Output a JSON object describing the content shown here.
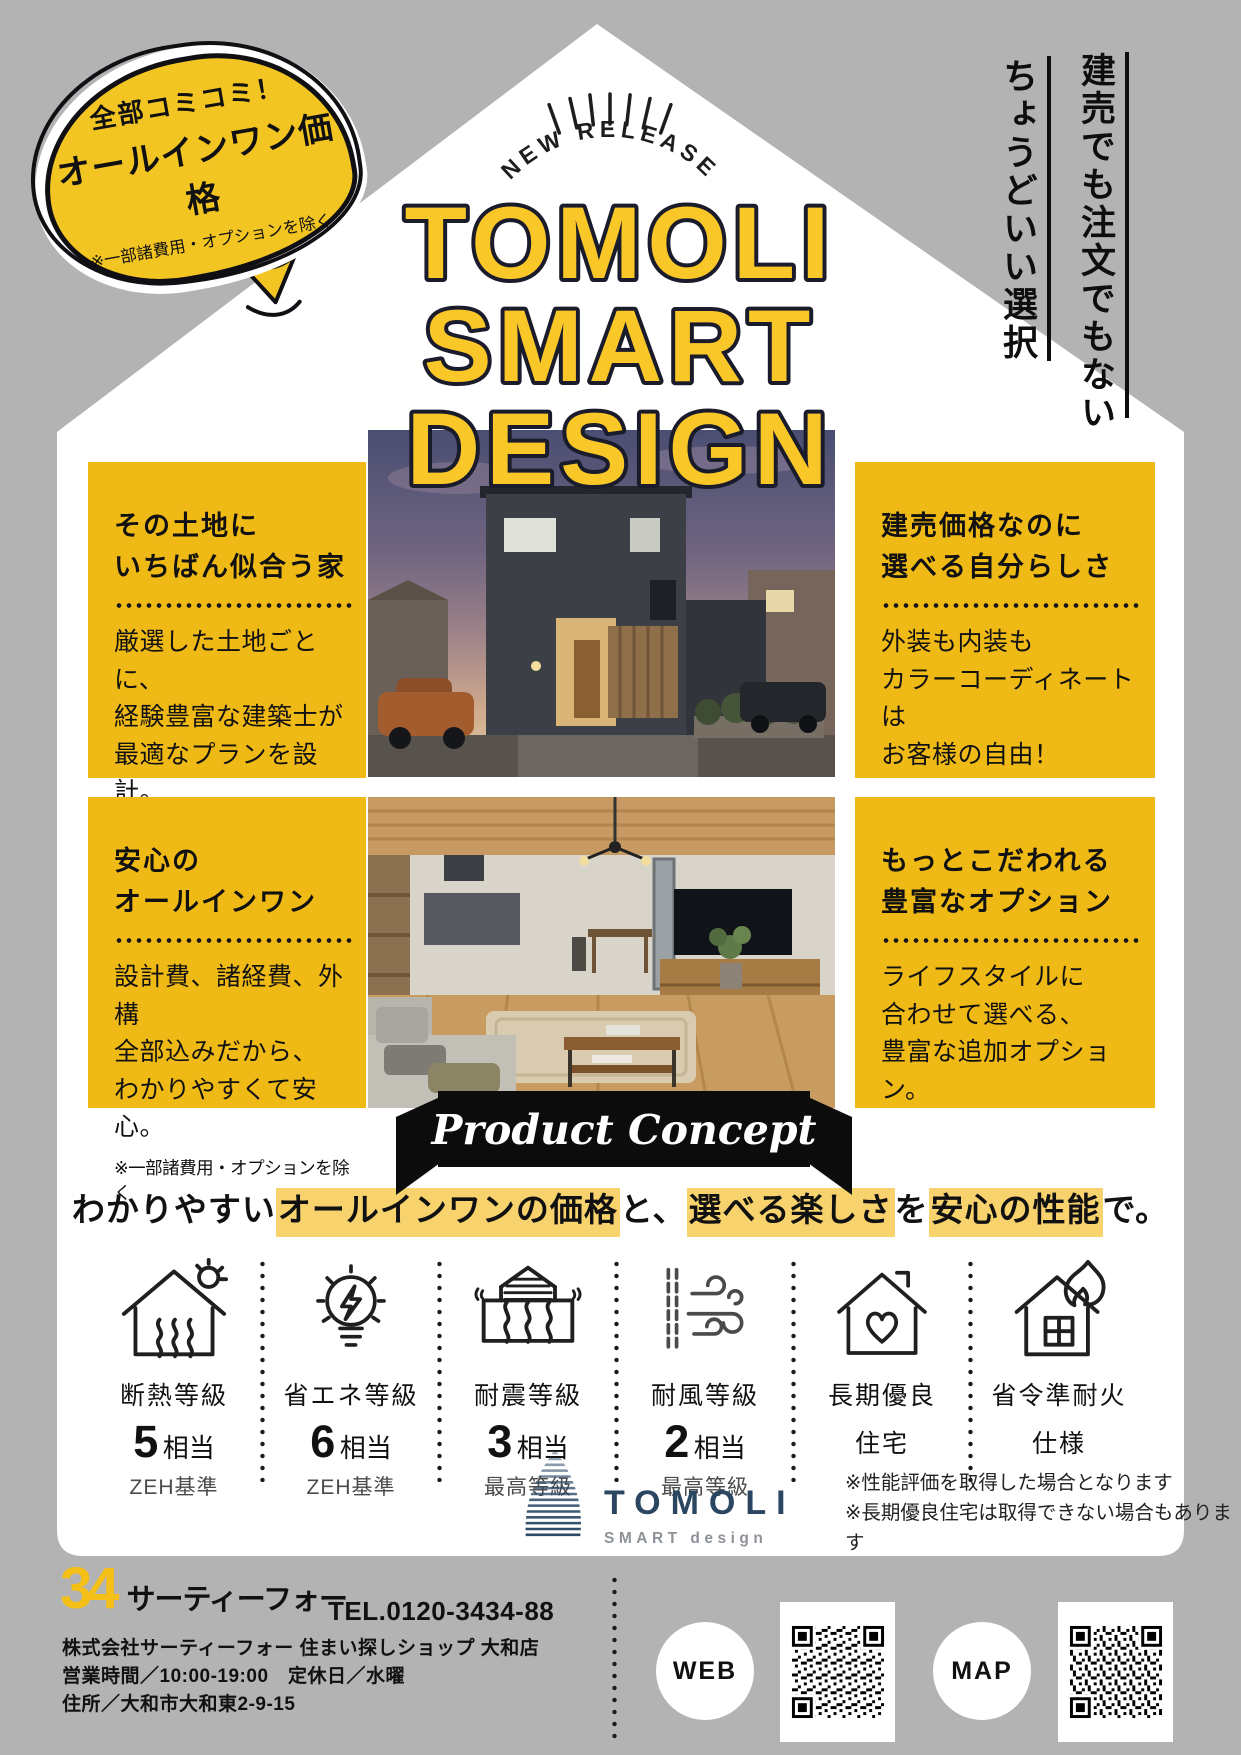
{
  "page": {
    "bg": "#b3b3b3",
    "card": "#ffffff",
    "accent_yellow": "#f0ba16",
    "title_yellow": "#f9c728",
    "highlight_yellow": "#f8d36d",
    "logo_navy": "#2b4660",
    "ink": "#111111"
  },
  "bubble": {
    "line1": "全部コミコミ！",
    "line2": "オールインワン価格",
    "note": "※一部諸費用・オプションを除く"
  },
  "vertical_copy": {
    "right": "建売でも注文でもない",
    "left": "ちょうどいい選択"
  },
  "release_badge": "NEW RELEASE",
  "title_lines": [
    "TOMOLI",
    "SMART",
    "DESIGN"
  ],
  "features": [
    {
      "title1": "その土地に",
      "title2": "いちばん似合う家",
      "body": [
        "厳選した土地ごとに、",
        "経験豊富な建築士が",
        "最適なプランを設計。"
      ]
    },
    {
      "title1": "建売価格なのに",
      "title2": "選べる自分らしさ",
      "body": [
        "外装も内装も",
        "カラーコーディネートは",
        "お客様の自由！"
      ]
    },
    {
      "title1": "安心の",
      "title2": "オールインワン",
      "body": [
        "設計費、諸経費、外構",
        "全部込みだから、",
        "わかりやすくて安心。"
      ],
      "note": "※一部諸費用・オプションを除く"
    },
    {
      "title1": "もっとこだわれる",
      "title2": "豊富なオプション",
      "body": [
        "ライフスタイルに",
        "合わせて選べる、",
        "豊富な追加オプション。"
      ]
    }
  ],
  "ribbon": "Product Concept",
  "tagline": {
    "segments": [
      {
        "text": "わかりやすい",
        "hl": false
      },
      {
        "text": "オールインワンの価格",
        "hl": true
      },
      {
        "text": "と、",
        "hl": false
      },
      {
        "text": "選べる楽しさ",
        "hl": true
      },
      {
        "text": "を",
        "hl": false
      },
      {
        "text": "安心の性能",
        "hl": true
      },
      {
        "text": "で。",
        "hl": false
      }
    ]
  },
  "specs": [
    {
      "icon": "insulation-house-icon",
      "name": "断熱等級",
      "value": "5",
      "unit": "相当",
      "sub": "ZEH基準"
    },
    {
      "icon": "energy-bulb-icon",
      "name": "省エネ等級",
      "value": "6",
      "unit": "相当",
      "sub": "ZEH基準"
    },
    {
      "icon": "quake-building-icon",
      "name": "耐震等級",
      "value": "3",
      "unit": "相当",
      "sub": "最高等級"
    },
    {
      "icon": "wind-icon",
      "name": "耐風等級",
      "value": "2",
      "unit": "相当",
      "sub": "最高等級"
    },
    {
      "icon": "heart-house-icon",
      "name": "長期優良",
      "name2": "住宅"
    },
    {
      "icon": "fire-house-icon",
      "name": "省令準耐火",
      "name2": "仕様"
    }
  ],
  "spec_notes": [
    "※性能評価を取得した場合となります",
    "※長期優良住宅は取得できない場合もあります"
  ],
  "logo": {
    "name": "TOMOLI",
    "sub": "SMART design"
  },
  "footer": {
    "brand_number": "34",
    "brand_name": "サーティーフォー",
    "tel": "TEL.0120-3434-88",
    "company": "株式会社サーティーフォー 住まい探しショップ 大和店",
    "hours": "営業時間／10:00-19:00　定休日／水曜",
    "address": "住所／大和市大和東2-9-15",
    "web_label": "WEB",
    "map_label": "MAP"
  }
}
